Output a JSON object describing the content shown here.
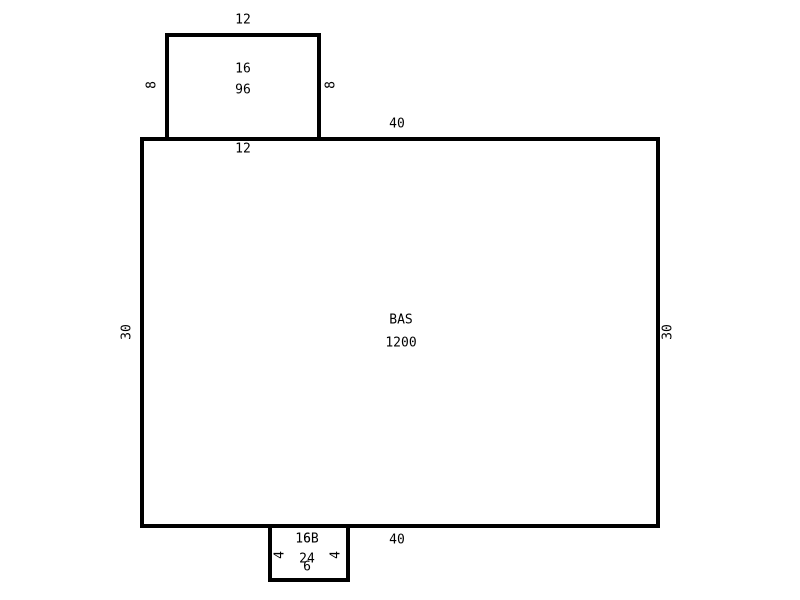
{
  "canvas": {
    "background_color": "#ffffff",
    "line_color": "#000000"
  },
  "sketch": {
    "type": "floor-plan-sketch",
    "areas": [
      {
        "id": "sub-area-top",
        "code": "16",
        "area_sqft": "96",
        "dims": {
          "top": "12",
          "bottom": "12",
          "left": "8",
          "right": "8"
        }
      },
      {
        "id": "base-area",
        "code": "BAS",
        "area_sqft": "1200",
        "dims": {
          "top": "40",
          "bottom": "40",
          "left": "30",
          "right": "30"
        }
      },
      {
        "id": "sub-area-bottom",
        "code": "16B",
        "area_sqft": "24",
        "dims": {
          "top": "6",
          "bottom": "6",
          "left": "4",
          "right": "4"
        }
      }
    ]
  }
}
